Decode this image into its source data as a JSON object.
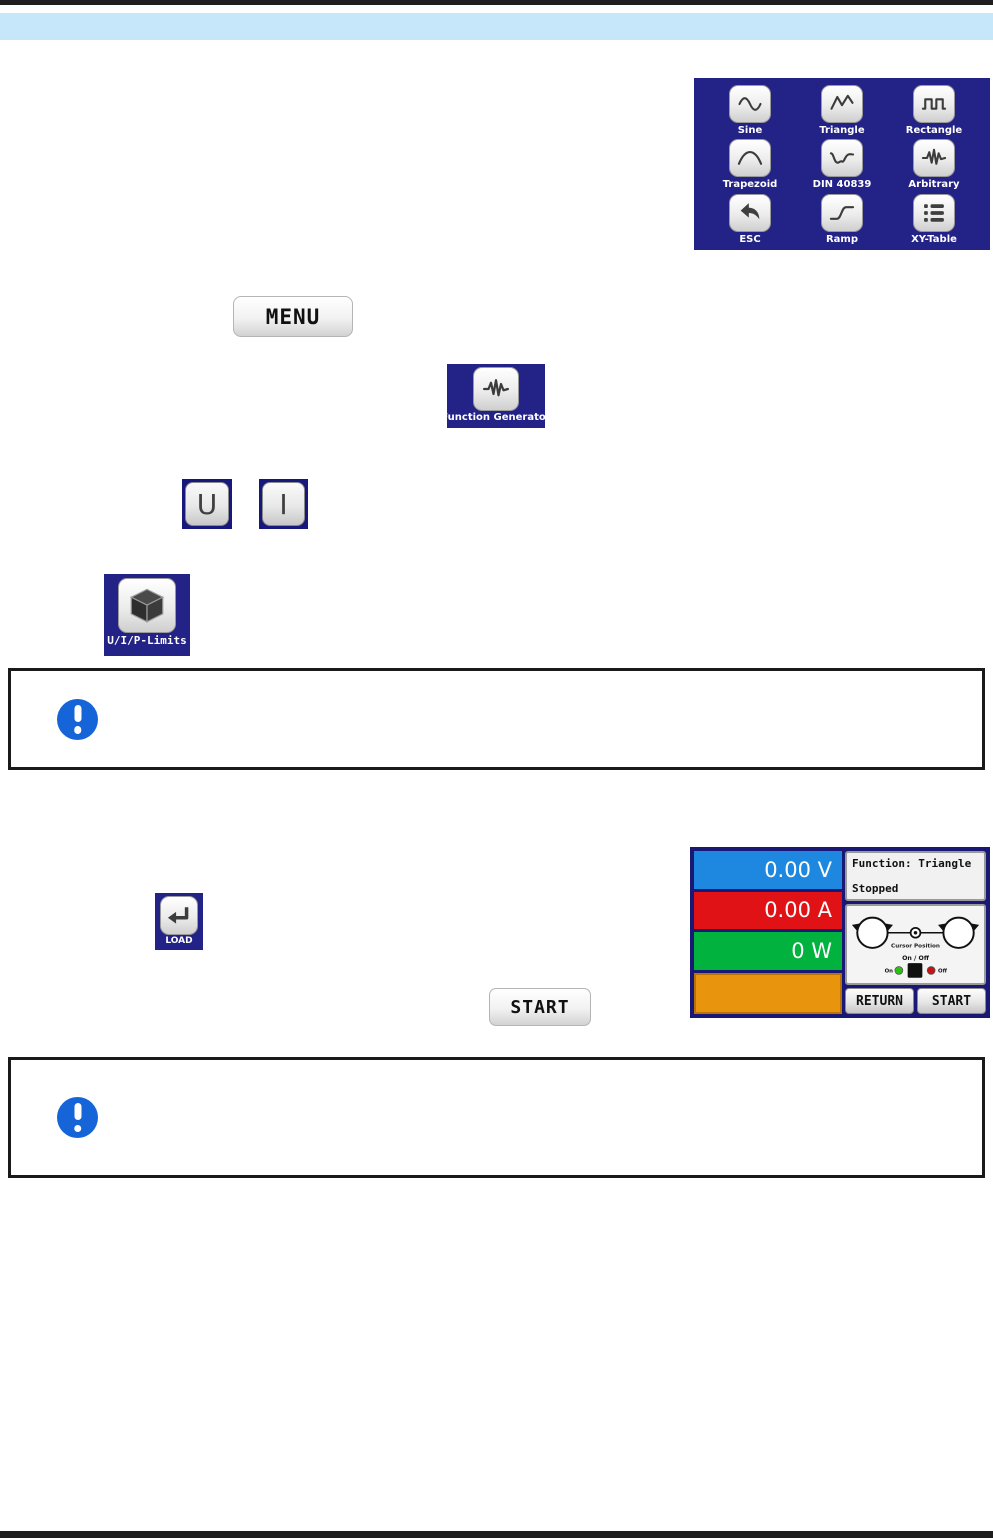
{
  "page": {
    "background": "#ffffff",
    "top_bar_color": "#1e1e1e",
    "header_band_color": "#c6e6fa",
    "bottom_bar_color": "#1e1e1e"
  },
  "function_menu": {
    "background_color": "#232287",
    "items": [
      {
        "label": "Sine",
        "icon": "sine-wave-icon"
      },
      {
        "label": "Triangle",
        "icon": "triangle-wave-icon"
      },
      {
        "label": "Rectangle",
        "icon": "rectangle-wave-icon"
      },
      {
        "label": "Trapezoid",
        "icon": "trapezoid-wave-icon"
      },
      {
        "label": "DIN 40839",
        "icon": "din-curve-icon"
      },
      {
        "label": "Arbitrary",
        "icon": "arbitrary-wave-icon"
      },
      {
        "label": "ESC",
        "icon": "back-arrow-icon"
      },
      {
        "label": "Ramp",
        "icon": "ramp-wave-icon"
      },
      {
        "label": "XY-Table",
        "icon": "list-icon"
      }
    ]
  },
  "buttons": {
    "menu": "MENU",
    "start": "START",
    "u": "U",
    "i": "I"
  },
  "tiles": {
    "function_generator": "Function Generator",
    "uip_limits": "U/I/P-Limits",
    "load": "LOAD"
  },
  "device_screen": {
    "voltage": "0.00 V",
    "current": "0.00 A",
    "power": "0 W",
    "function_line": "Function: Triangle",
    "status_line": "Stopped",
    "cursor_label": "Cursor Position",
    "onoff_label": "On / Off",
    "on_label": "On",
    "off_label": "Off",
    "return_button": "RETURN",
    "start_button": "START",
    "colors": {
      "frame": "#191975",
      "voltage_bar": "#1e87e0",
      "current_bar": "#e01216",
      "power_bar": "#01b33e",
      "extra_bar": "#e8940c",
      "led_on": "#2cc012",
      "led_off": "#cc1111"
    }
  },
  "notice": {
    "icon": "exclamation-icon",
    "icon_color": "#1565d8"
  }
}
